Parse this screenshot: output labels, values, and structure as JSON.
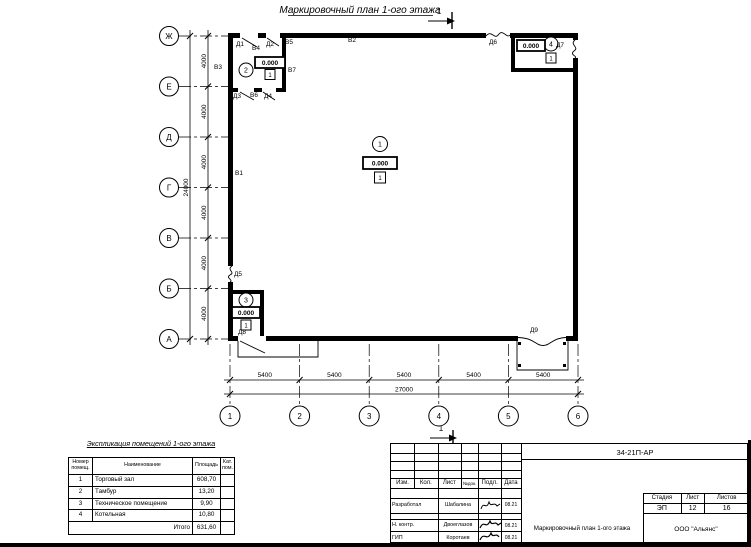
{
  "drawing": {
    "title": "Маркировочный план 1-ого этажа",
    "section_cut_label": "1"
  },
  "axes": {
    "rows": [
      "Ж",
      "Е",
      "Д",
      "Г",
      "В",
      "Б",
      "А"
    ],
    "cols": [
      "1",
      "2",
      "3",
      "4",
      "5",
      "6"
    ],
    "row_spacing": "4000",
    "row_total": "24000",
    "col_spacing": "5400",
    "col_total": "27000"
  },
  "rooms": [
    {
      "number": "1",
      "elevation": "0.000",
      "floor_mark": "1"
    },
    {
      "number": "2",
      "elevation": "0.000",
      "floor_mark": "1"
    },
    {
      "number": "3",
      "elevation": "0.000",
      "floor_mark": "1"
    },
    {
      "number": "4",
      "elevation": "0.000",
      "floor_mark": "1"
    }
  ],
  "marks": {
    "walls": [
      "В1",
      "В2",
      "В3",
      "В4",
      "В5",
      "В6",
      "В7"
    ],
    "doors": [
      "Д1",
      "Д2",
      "Д3",
      "Д4",
      "Д5",
      "Д6",
      "Д7",
      "Д8",
      "Д9"
    ]
  },
  "explication": {
    "title": "Экспликация помещений 1-ого этажа",
    "headers": {
      "num": "Номер помещ.",
      "name": "Наименование",
      "area": "Площадь",
      "cat": "Кат. пом."
    },
    "rows": [
      {
        "num": "1",
        "name": "Торговый зал",
        "area": "608,70"
      },
      {
        "num": "2",
        "name": "Тамбур",
        "area": "13,20"
      },
      {
        "num": "3",
        "name": "Техническое помещение",
        "area": "9,90"
      },
      {
        "num": "4",
        "name": "Котельная",
        "area": "10,80"
      }
    ],
    "total_label": "Итого",
    "total_area": "631,60"
  },
  "titleblock": {
    "doc_code": "34-21П-АР",
    "columns": [
      "Изм.",
      "Кол.",
      "Лист",
      "№док.",
      "Подл.",
      "Дата"
    ],
    "sign_rows": [
      {
        "role": "Разработал",
        "name": "Шабалина",
        "date": "08.21"
      },
      {
        "role": "Н. контр.",
        "name": "Двоеглазов",
        "date": "08.21"
      },
      {
        "role": "ГИП",
        "name": "Коротаев",
        "date": "08.21"
      }
    ],
    "stage_label": "Стадия",
    "sheet_label": "Лист",
    "sheets_label": "Листов",
    "stage": "ЭП",
    "sheet_number": "12",
    "sheets_total": "16",
    "drawing_name": "Маркировочный план 1-ого этажа",
    "company": "ООО \"Альянс\""
  }
}
